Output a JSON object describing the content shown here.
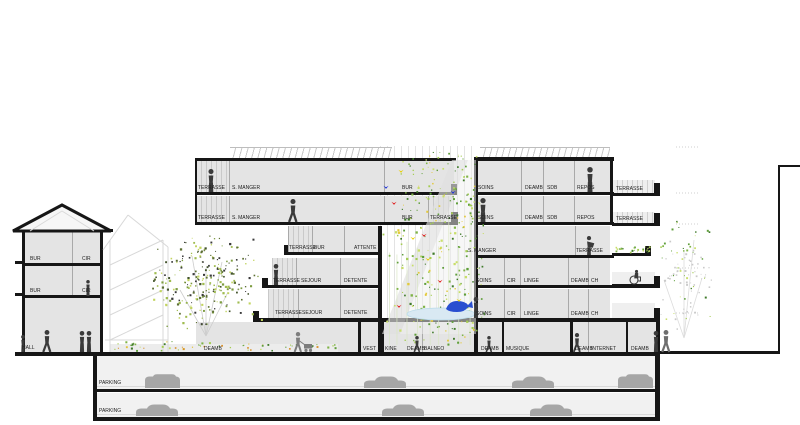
{
  "title": "architectural-building-section",
  "palette": {
    "background": "#ffffff",
    "slab_black": "#161616",
    "room_gray": "#e4e4e4",
    "wall_gray": "#a9a9a9",
    "figure_dark": "#3a3a3a",
    "figure_light": "#7d7d7d",
    "car_gray": "#a6a6a6",
    "pond_blue": "#d9e9f3",
    "whale_blue": "#2a4fd0",
    "bird_red": "#e01818",
    "bird_yellow": "#e8cf00",
    "bird_blue": "#1a2fd8",
    "foliage_greens": [
      "#5f9e3a",
      "#7fb347",
      "#a4cc52",
      "#c8de6a",
      "#3f7a2a"
    ],
    "tree_dark_greens": [
      "#43532c",
      "#5d7033",
      "#7d9c41",
      "#9fbc4f",
      "#3a3a3a",
      "#c2d45f"
    ],
    "leaf_light_gray": "#c9c9c9",
    "hedge_orange": "#d8922e"
  },
  "icons": {
    "person": "person-silhouette",
    "wheelchair": "wheelchair-person-silhouette",
    "pram": "person-with-pram-silhouette",
    "car": "car-silhouette",
    "bird": "bird-mark",
    "whale": "whale-figure",
    "tree": "tree-foliage"
  },
  "labels": {
    "rooms": [
      {
        "t": "BUR",
        "x": 30,
        "y": 257
      },
      {
        "t": "CIR",
        "x": 82,
        "y": 257
      },
      {
        "t": "BUR",
        "x": 30,
        "y": 289
      },
      {
        "t": "CIR",
        "x": 82,
        "y": 289
      },
      {
        "t": "HALL",
        "x": 22,
        "y": 346
      },
      {
        "t": "TERRASSE",
        "x": 198,
        "y": 186
      },
      {
        "t": "S. MANGER",
        "x": 232,
        "y": 186
      },
      {
        "t": "BUR",
        "x": 402,
        "y": 186
      },
      {
        "t": "TERRASSE",
        "x": 198,
        "y": 216
      },
      {
        "t": "S. MANGER",
        "x": 232,
        "y": 216
      },
      {
        "t": "BUR",
        "x": 402,
        "y": 216
      },
      {
        "t": "TERRASSE",
        "x": 430,
        "y": 216
      },
      {
        "t": "TERRASSE",
        "x": 289,
        "y": 246
      },
      {
        "t": "BUR",
        "x": 314,
        "y": 246
      },
      {
        "t": "ATTENTE",
        "x": 354,
        "y": 246
      },
      {
        "t": "TERRASSE",
        "x": 273,
        "y": 279
      },
      {
        "t": "SEJOUR",
        "x": 301,
        "y": 279
      },
      {
        "t": "DETENTE",
        "x": 344,
        "y": 279
      },
      {
        "t": "TERRASSE",
        "x": 275,
        "y": 311
      },
      {
        "t": "SEJOUR",
        "x": 302,
        "y": 311
      },
      {
        "t": "DETENTE",
        "x": 344,
        "y": 311
      },
      {
        "t": "SOINS",
        "x": 478,
        "y": 186
      },
      {
        "t": "DEAMB",
        "x": 525,
        "y": 186
      },
      {
        "t": "SDB",
        "x": 547,
        "y": 186
      },
      {
        "t": "REPOS",
        "x": 577,
        "y": 186
      },
      {
        "t": "TERRASSE",
        "x": 616,
        "y": 187
      },
      {
        "t": "SOINS",
        "x": 478,
        "y": 216
      },
      {
        "t": "DEAMB",
        "x": 525,
        "y": 216
      },
      {
        "t": "SDB",
        "x": 547,
        "y": 216
      },
      {
        "t": "REPOS",
        "x": 577,
        "y": 216
      },
      {
        "t": "TERRASSE",
        "x": 616,
        "y": 217
      },
      {
        "t": "S. MANGER",
        "x": 468,
        "y": 249
      },
      {
        "t": "TERRASSE",
        "x": 576,
        "y": 249
      },
      {
        "t": "SOINS",
        "x": 476,
        "y": 279
      },
      {
        "t": "CIR",
        "x": 507,
        "y": 279
      },
      {
        "t": "LINGE",
        "x": 524,
        "y": 279
      },
      {
        "t": "DEAMB",
        "x": 571,
        "y": 279
      },
      {
        "t": "CH",
        "x": 591,
        "y": 279
      },
      {
        "t": "SOINS",
        "x": 476,
        "y": 312
      },
      {
        "t": "CIR",
        "x": 507,
        "y": 312
      },
      {
        "t": "LINGE",
        "x": 524,
        "y": 312
      },
      {
        "t": "DEAMB",
        "x": 571,
        "y": 312
      },
      {
        "t": "CH",
        "x": 591,
        "y": 312
      },
      {
        "t": "DEAMB",
        "x": 204,
        "y": 347
      },
      {
        "t": "VEST",
        "x": 363,
        "y": 347
      },
      {
        "t": "KINE",
        "x": 385,
        "y": 347
      },
      {
        "t": "DEAMB",
        "x": 407,
        "y": 347
      },
      {
        "t": "BALNEO",
        "x": 424,
        "y": 347
      },
      {
        "t": "DEAMB",
        "x": 481,
        "y": 347
      },
      {
        "t": "MUSIQUE",
        "x": 506,
        "y": 347
      },
      {
        "t": "DEAMB",
        "x": 575,
        "y": 347
      },
      {
        "t": "INTERNET",
        "x": 591,
        "y": 347
      },
      {
        "t": "DEAMB",
        "x": 631,
        "y": 347
      }
    ],
    "parking": [
      {
        "t": "PARKING",
        "x": 99,
        "y": 381
      },
      {
        "t": "PARKING",
        "x": 99,
        "y": 409
      }
    ]
  }
}
